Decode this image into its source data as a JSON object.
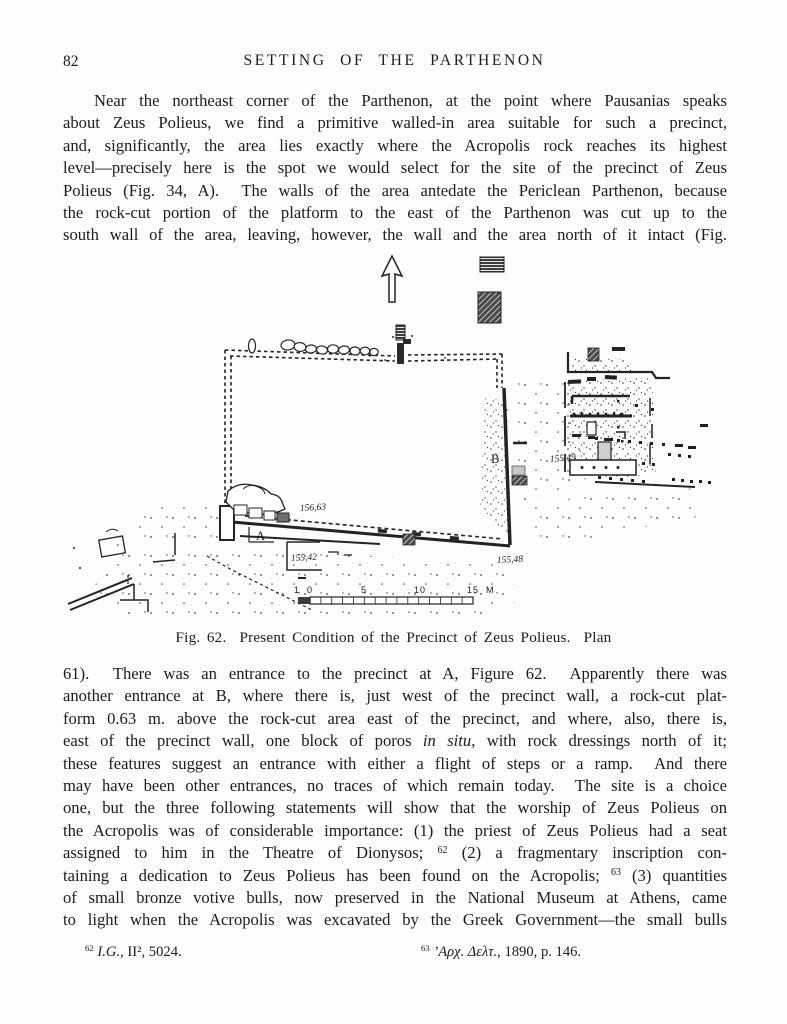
{
  "page": {
    "number": "82",
    "header": "SETTING OF THE PARTHENON"
  },
  "paragraphs": [
    {
      "indent": true,
      "lines": [
        "Near the northeast corner of the Parthenon, at the point where Pausanias speaks",
        "about Zeus Polieus, we find a primitive walled-in area suitable for such a precinct,",
        "and, significantly, the area lies exactly where the Acropolis rock reaches its highest",
        "level—precisely here is the spot we would select for the site of the precinct of Zeus",
        "Polieus (Fig. 34, A).  The walls of the area antedate the Periclean Parthenon, because",
        "the rock-cut portion of the platform to the east of the Parthenon was cut up to the",
        "south wall of the area, leaving, however, the wall and the area north of it intact (Fig."
      ]
    },
    {
      "indent": false,
      "lines": [
        "61).  There was an entrance to the precinct at A, Figure 62.  Apparently there was",
        "another entrance at B, where there is, just west of the precinct wall, a rock-cut plat-",
        "form 0.63 m. above the rock-cut area east of the precinct, and where, also, there is,",
        "east of the precinct wall, one block of poros *in situ*, with rock dressings north of it;",
        "these features suggest an entrance with either a flight of steps or a ramp.  And there",
        "may have been other entrances, no traces of which remain today.  The site is a choice",
        "one, but the three following statements will show that the worship of Zeus Polieus on",
        "the Acropolis was of considerable importance: (1) the priest of Zeus Polieus had a seat",
        "assigned to him in the Theatre of Dionysos; ^62^ (2) a fragmentary inscription con-",
        "taining a dedication to Zeus Polieus has been found on the Acropolis; ^63^ (3) quantities",
        "of small bronze votive bulls, now preserved in the National Museum at Athens, came",
        "to light when the Acropolis was excavated by the Greek Government—the small bulls"
      ]
    }
  ],
  "figure": {
    "caption": "Fig. 62.  Present Condition of the Precinct of Zeus Polieus.  Plan",
    "labels": {
      "entrance_a": "A",
      "entrance_b": "B",
      "elev_wall": "156,63",
      "elev_platform": "155,42",
      "elev_se_corner": "155,48",
      "elev_east_area": "155,49"
    },
    "scale": {
      "ticks": [
        "1",
        "0",
        "5",
        "10",
        "15"
      ],
      "unit": "M"
    }
  },
  "footnotes": [
    {
      "text": "^62^ *I.G.*, II², 5024."
    },
    {
      "text": "^63^ *’Αρχ. Δελτ.*, 1890, p. 146."
    }
  ]
}
